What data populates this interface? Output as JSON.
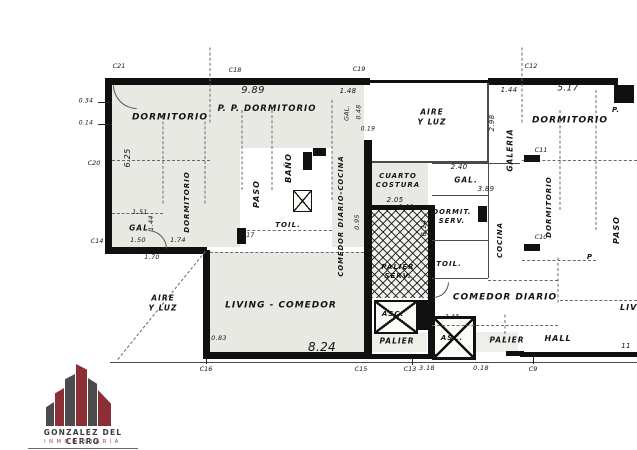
{
  "plan": {
    "rooms": {
      "dormitorio_nw": "DORMITORIO",
      "pp_dormitorio": "P. P. DORMITORIO",
      "dormitorio_w": "DORMITORIO",
      "bano": "BAÑO",
      "paso_left": "PASO",
      "gal_left": "GAL",
      "gal_small": "GAL.",
      "comedor_diario_cocina": "COMEDOR DIARIO-COCINA",
      "toil_left": "TOIL.",
      "living_comedor": "LIVING - COMEDOR",
      "aire_y_luz_left": "AIRE\nY LUZ",
      "aire_y_luz_top": "AIRE\nY LUZ",
      "cuarto_costura": "CUARTO\nCOSTURA",
      "palier_serv": "PALIER\nSERV.",
      "asc_1": "ASC.",
      "palier_1": "PALIER",
      "asc_2": "ASC.",
      "palier_2": "PALIER",
      "dormitorio_ne": "DORMITORIO",
      "galeria": "GALERIA",
      "gal_right": "GAL.",
      "dormit_serv": "DORMIT.\nSERV.",
      "cocina": "COCINA",
      "dormitorio_e": "DORMITORIO",
      "paso_right": "PASO",
      "toil_right": "TOIL.",
      "comedor_diario": "COMEDOR DIARIO",
      "hall": "HALL",
      "living_right": "LIVING",
      "p_1": "P.",
      "p_2": "P"
    },
    "dimensions": {
      "d_989": "9.89",
      "d_517": "5.17",
      "d_144a": "1.44",
      "d_148": "1.48",
      "d_048": "0.48",
      "d_019": "0.19",
      "d_298": "2.98",
      "d_625": "6.25",
      "d_034": "0.34",
      "d_014": "0.14",
      "d_151": "1.51",
      "d_144b": "1.44",
      "d_150": "1.50",
      "d_174": "1.74",
      "d_170": "1.70",
      "d_240": "2.40",
      "d_389": "3.89",
      "d_205": "2.05",
      "d_144c": "1.44",
      "d_095": "0.95",
      "d_614": "6.14",
      "d_427": "4.27",
      "d_083": "0.83",
      "d_824": "8.24",
      "d_243": "2.43",
      "d_318": "3.18",
      "d_018": "0.18",
      "d_11": "11"
    },
    "markers": {
      "c21": "C21",
      "c18": "C18",
      "c19": "C19",
      "c12": "C12",
      "c20": "C20",
      "c14": "C14",
      "c17": "C17",
      "c11": "C11",
      "c10": "C10",
      "c16": "C16",
      "c15": "C15",
      "c13": "C13",
      "c9": "C9"
    }
  },
  "logo": {
    "company": "GONZALEZ DEL CERRO",
    "tagline": "INMOBILIARIA",
    "colors": {
      "building_gray": "#4b4b4d",
      "building_red": "#8c2f34"
    }
  }
}
